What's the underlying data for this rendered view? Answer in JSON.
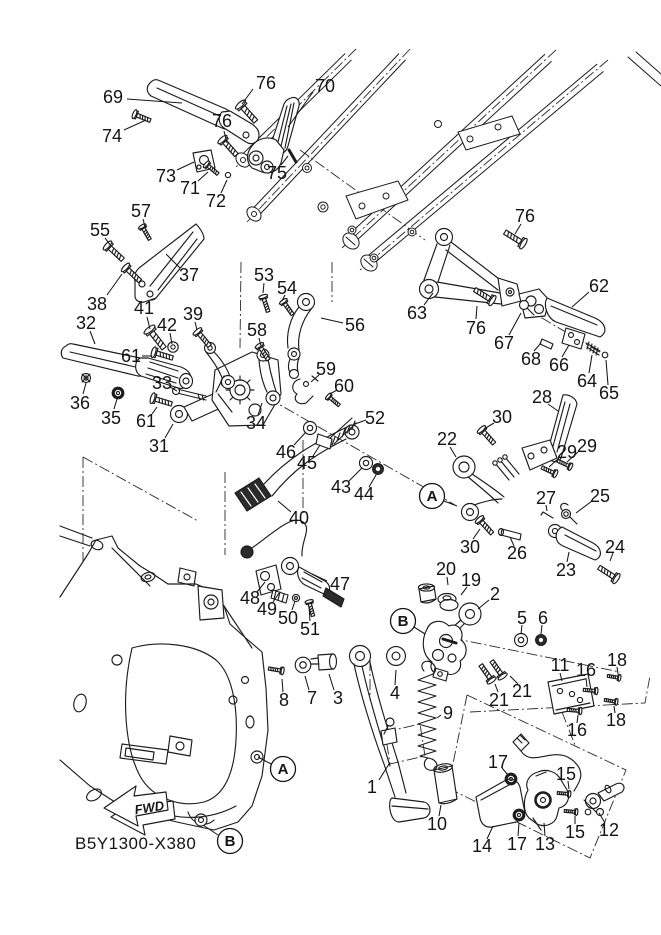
{
  "diagram": {
    "part_code": "B5Y1300-X380",
    "fwd_label": "FWD",
    "line_color": "#1c1c1c",
    "background": "#ffffff",
    "ref_markers": [
      {
        "label": "A",
        "x": 432,
        "y": 496,
        "leader": [
          444,
          501,
          457,
          506
        ]
      },
      {
        "label": "A",
        "x": 283,
        "y": 769,
        "leader": [
          271,
          764,
          258,
          757
        ]
      },
      {
        "label": "B",
        "x": 403,
        "y": 621,
        "leader": [
          414,
          627,
          425,
          634
        ]
      },
      {
        "label": "B",
        "x": 230,
        "y": 841,
        "leader": [
          218,
          835,
          203,
          825
        ]
      }
    ],
    "callouts": [
      {
        "n": "69",
        "x": 113,
        "y": 97,
        "leader": [
          127,
          99,
          182,
          103
        ]
      },
      {
        "n": "74",
        "x": 112,
        "y": 136,
        "leader": [
          124,
          130,
          146,
          120
        ]
      },
      {
        "n": "76",
        "x": 266,
        "y": 83,
        "leader": [
          253,
          89,
          242,
          104
        ]
      },
      {
        "n": "70",
        "x": 325,
        "y": 86,
        "leader": [
          313,
          92,
          288,
          127
        ]
      },
      {
        "n": "76",
        "x": 222,
        "y": 121,
        "leader": [
          224,
          131,
          227,
          143
        ]
      },
      {
        "n": "73",
        "x": 166,
        "y": 176,
        "leader": [
          177,
          170,
          194,
          162
        ]
      },
      {
        "n": "71",
        "x": 190,
        "y": 188,
        "leader": [
          198,
          181,
          208,
          172
        ]
      },
      {
        "n": "72",
        "x": 216,
        "y": 201,
        "leader": [
          221,
          193,
          227,
          180
        ]
      },
      {
        "n": "75",
        "x": 277,
        "y": 173,
        "leader": [
          281,
          165,
          288,
          156
        ]
      },
      {
        "n": "57",
        "x": 141,
        "y": 211,
        "leader": [
          143,
          219,
          145,
          227
        ]
      },
      {
        "n": "55",
        "x": 100,
        "y": 230,
        "leader": [
          105,
          238,
          111,
          246
        ]
      },
      {
        "n": "37",
        "x": 189,
        "y": 275,
        "leader": [
          180,
          268,
          166,
          254
        ]
      },
      {
        "n": "38",
        "x": 97,
        "y": 304,
        "leader": [
          107,
          295,
          122,
          274
        ]
      },
      {
        "n": "32",
        "x": 86,
        "y": 323,
        "leader": [
          90,
          331,
          95,
          344
        ]
      },
      {
        "n": "41",
        "x": 144,
        "y": 308,
        "leader": [
          147,
          317,
          150,
          329
        ]
      },
      {
        "n": "42",
        "x": 167,
        "y": 325,
        "leader": [
          170,
          333,
          172,
          344
        ]
      },
      {
        "n": "39",
        "x": 193,
        "y": 314,
        "leader": [
          195,
          322,
          197,
          330
        ]
      },
      {
        "n": "61",
        "x": 131,
        "y": 356,
        "leader": [
          142,
          356,
          152,
          356
        ]
      },
      {
        "n": "36",
        "x": 80,
        "y": 403,
        "leader": [
          83,
          394,
          86,
          383
        ]
      },
      {
        "n": "35",
        "x": 111,
        "y": 418,
        "leader": [
          114,
          409,
          117,
          399
        ]
      },
      {
        "n": "33",
        "x": 162,
        "y": 383,
        "leader": [
          170,
          387,
          177,
          391
        ]
      },
      {
        "n": "61",
        "x": 146,
        "y": 421,
        "leader": [
          152,
          414,
          157,
          407
        ]
      },
      {
        "n": "31",
        "x": 159,
        "y": 446,
        "leader": [
          165,
          438,
          173,
          424
        ]
      },
      {
        "n": "34",
        "x": 256,
        "y": 423,
        "leader": [
          258,
          415,
          262,
          403
        ]
      },
      {
        "n": "53",
        "x": 264,
        "y": 275,
        "leader": [
          264,
          283,
          263,
          293
        ]
      },
      {
        "n": "54",
        "x": 287,
        "y": 288,
        "leader": [
          285,
          295,
          282,
          301
        ]
      },
      {
        "n": "58",
        "x": 257,
        "y": 330,
        "leader": [
          259,
          338,
          261,
          346
        ]
      },
      {
        "n": "56",
        "x": 355,
        "y": 325,
        "leader": [
          343,
          323,
          321,
          318
        ]
      },
      {
        "n": "59",
        "x": 326,
        "y": 369,
        "leader": [
          319,
          375,
          311,
          382
        ]
      },
      {
        "n": "60",
        "x": 344,
        "y": 386,
        "leader": [
          337,
          390,
          330,
          394
        ]
      },
      {
        "n": "52",
        "x": 375,
        "y": 418,
        "leader": [
          366,
          420,
          355,
          424
        ]
      },
      {
        "n": "46",
        "x": 286,
        "y": 452,
        "leader": [
          294,
          445,
          306,
          432
        ]
      },
      {
        "n": "45",
        "x": 307,
        "y": 463,
        "leader": [
          313,
          456,
          320,
          445
        ]
      },
      {
        "n": "43",
        "x": 341,
        "y": 487,
        "leader": [
          349,
          481,
          362,
          468
        ]
      },
      {
        "n": "44",
        "x": 364,
        "y": 494,
        "leader": [
          369,
          487,
          376,
          475
        ]
      },
      {
        "n": "40",
        "x": 299,
        "y": 518,
        "leader": [
          291,
          512,
          278,
          501
        ]
      },
      {
        "n": "47",
        "x": 340,
        "y": 584,
        "leader": [
          327,
          581,
          312,
          574
        ]
      },
      {
        "n": "48",
        "x": 250,
        "y": 598,
        "leader": [
          257,
          592,
          265,
          582
        ]
      },
      {
        "n": "49",
        "x": 267,
        "y": 609,
        "leader": [
          273,
          602,
          279,
          593
        ]
      },
      {
        "n": "50",
        "x": 288,
        "y": 618,
        "leader": [
          292,
          610,
          295,
          601
        ]
      },
      {
        "n": "51",
        "x": 310,
        "y": 629,
        "leader": [
          310,
          621,
          309,
          606
        ]
      },
      {
        "n": "76",
        "x": 525,
        "y": 216,
        "leader": [
          521,
          224,
          515,
          234
        ]
      },
      {
        "n": "63",
        "x": 417,
        "y": 313,
        "leader": [
          424,
          305,
          433,
          293
        ]
      },
      {
        "n": "76",
        "x": 476,
        "y": 328,
        "leader": [
          476,
          319,
          477,
          306
        ]
      },
      {
        "n": "62",
        "x": 599,
        "y": 286,
        "leader": [
          589,
          292,
          572,
          307
        ]
      },
      {
        "n": "67",
        "x": 504,
        "y": 343,
        "leader": [
          509,
          335,
          521,
          313
        ]
      },
      {
        "n": "68",
        "x": 531,
        "y": 359,
        "leader": [
          534,
          351,
          541,
          343
        ]
      },
      {
        "n": "66",
        "x": 559,
        "y": 365,
        "leader": [
          562,
          357,
          569,
          345
        ]
      },
      {
        "n": "64",
        "x": 587,
        "y": 381,
        "leader": [
          589,
          373,
          592,
          355
        ]
      },
      {
        "n": "65",
        "x": 609,
        "y": 393,
        "leader": [
          608,
          385,
          606,
          360
        ]
      },
      {
        "n": "28",
        "x": 542,
        "y": 397,
        "leader": [
          548,
          404,
          558,
          411
        ]
      },
      {
        "n": "30",
        "x": 502,
        "y": 417,
        "leader": [
          494,
          423,
          484,
          429
        ]
      },
      {
        "n": "22",
        "x": 447,
        "y": 439,
        "leader": [
          450,
          447,
          456,
          457
        ]
      },
      {
        "n": "29",
        "x": 567,
        "y": 452,
        "leader": [
          559,
          458,
          549,
          467
        ]
      },
      {
        "n": "29",
        "x": 587,
        "y": 446,
        "leader": [
          578,
          452,
          567,
          462
        ]
      },
      {
        "n": "27",
        "x": 546,
        "y": 498,
        "leader": [
          546,
          505,
          547,
          511
        ]
      },
      {
        "n": "25",
        "x": 600,
        "y": 496,
        "leader": [
          592,
          501,
          576,
          513
        ]
      },
      {
        "n": "30",
        "x": 470,
        "y": 547,
        "leader": [
          473,
          539,
          480,
          529
        ]
      },
      {
        "n": "26",
        "x": 517,
        "y": 553,
        "leader": [
          514,
          546,
          510,
          537
        ]
      },
      {
        "n": "23",
        "x": 566,
        "y": 570,
        "leader": [
          567,
          562,
          569,
          552
        ]
      },
      {
        "n": "24",
        "x": 615,
        "y": 547,
        "leader": [
          613,
          553,
          610,
          561
        ]
      },
      {
        "n": "20",
        "x": 446,
        "y": 569,
        "leader": [
          447,
          577,
          448,
          585
        ]
      },
      {
        "n": "19",
        "x": 471,
        "y": 580,
        "leader": [
          467,
          587,
          461,
          595
        ]
      },
      {
        "n": "2",
        "x": 495,
        "y": 594,
        "leader": [
          489,
          600,
          478,
          609
        ]
      },
      {
        "n": "5",
        "x": 522,
        "y": 618,
        "leader": [
          522,
          625,
          521,
          634
        ]
      },
      {
        "n": "6",
        "x": 543,
        "y": 618,
        "leader": [
          542,
          625,
          541,
          634
        ]
      },
      {
        "n": "21",
        "x": 499,
        "y": 700,
        "leader": [
          498,
          692,
          495,
          684
        ]
      },
      {
        "n": "21",
        "x": 522,
        "y": 691,
        "leader": [
          518,
          684,
          510,
          676
        ]
      },
      {
        "n": "11",
        "x": 560,
        "y": 665,
        "leader": [
          560,
          673,
          562,
          681
        ]
      },
      {
        "n": "16",
        "x": 586,
        "y": 670,
        "leader": [
          586,
          678,
          587,
          687
        ]
      },
      {
        "n": "18",
        "x": 617,
        "y": 660,
        "leader": [
          617,
          667,
          618,
          674
        ]
      },
      {
        "n": "18",
        "x": 616,
        "y": 720,
        "leader": [
          615,
          713,
          614,
          706
        ]
      },
      {
        "n": "16",
        "x": 577,
        "y": 730,
        "leader": [
          577,
          723,
          578,
          715
        ]
      },
      {
        "n": "8",
        "x": 284,
        "y": 700,
        "leader": [
          283,
          692,
          282,
          679
        ]
      },
      {
        "n": "7",
        "x": 312,
        "y": 698,
        "leader": [
          309,
          690,
          305,
          676
        ]
      },
      {
        "n": "3",
        "x": 338,
        "y": 698,
        "leader": [
          334,
          690,
          329,
          674
        ]
      },
      {
        "n": "4",
        "x": 395,
        "y": 693,
        "leader": [
          395,
          685,
          396,
          670
        ]
      },
      {
        "n": "9",
        "x": 448,
        "y": 713,
        "leader": [
          441,
          715,
          437,
          718
        ]
      },
      {
        "n": "1",
        "x": 372,
        "y": 787,
        "leader": [
          379,
          780,
          389,
          764
        ]
      },
      {
        "n": "10",
        "x": 437,
        "y": 824,
        "leader": [
          439,
          816,
          441,
          805
        ]
      },
      {
        "n": "17",
        "x": 498,
        "y": 762,
        "leader": [
          502,
          768,
          508,
          775
        ]
      },
      {
        "n": "15",
        "x": 566,
        "y": 774,
        "leader": [
          568,
          781,
          569,
          789
        ]
      },
      {
        "n": "15",
        "x": 575,
        "y": 832,
        "leader": [
          575,
          824,
          575,
          816
        ]
      },
      {
        "n": "12",
        "x": 609,
        "y": 830,
        "leader": [
          605,
          823,
          599,
          813
        ]
      },
      {
        "n": "14",
        "x": 482,
        "y": 846,
        "leader": [
          487,
          839,
          493,
          826
        ]
      },
      {
        "n": "17",
        "x": 517,
        "y": 844,
        "leader": [
          518,
          836,
          519,
          823
        ]
      },
      {
        "n": "13",
        "x": 545,
        "y": 844,
        "leader": [
          545,
          836,
          544,
          823
        ]
      }
    ]
  }
}
